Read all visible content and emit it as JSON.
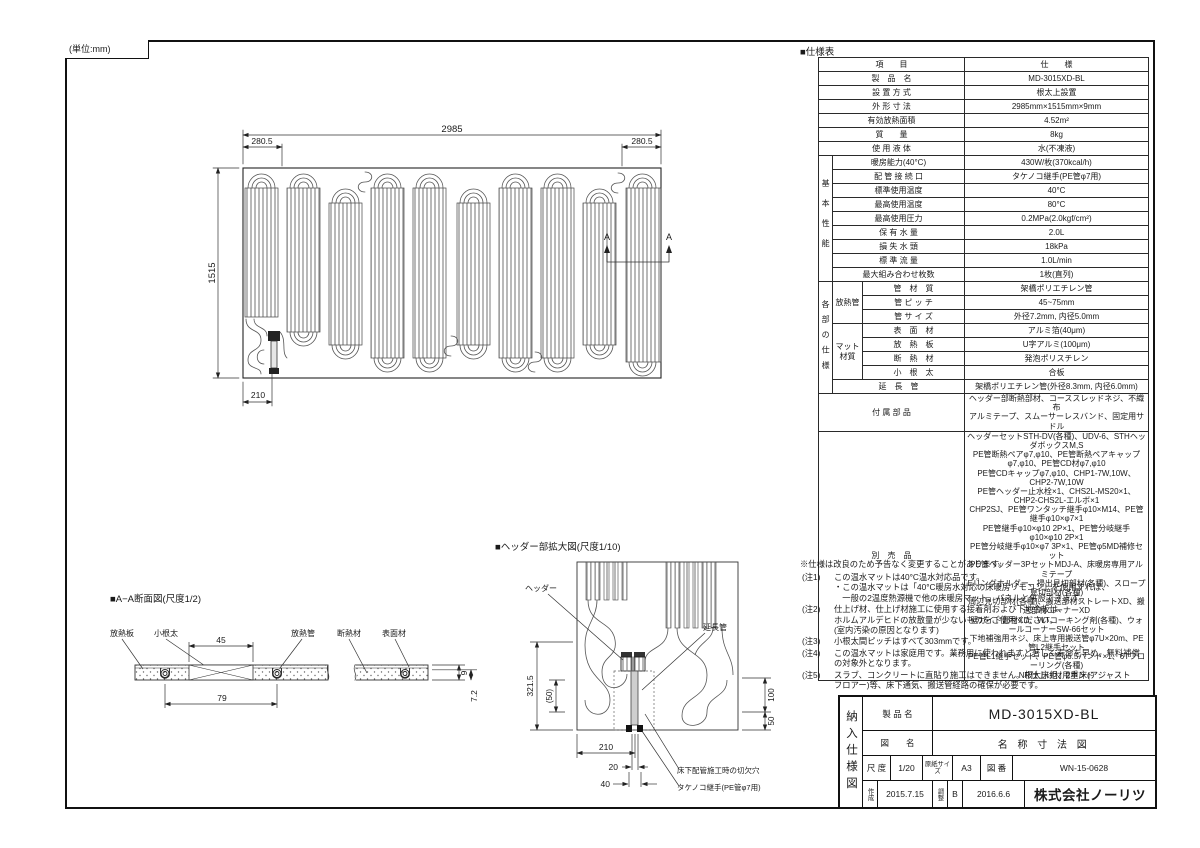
{
  "meta": {
    "unit": "(単位:mm)"
  },
  "plan": {
    "dim_overall_w": "2985",
    "dim_end_left": "280.5",
    "dim_end_right": "280.5",
    "dim_overall_h": "1515",
    "dim_header_x": "210",
    "marker": "A"
  },
  "section": {
    "title": "■A−A断面図(尺度1/2)",
    "label_plate": "放熱板",
    "label_joist": "小根太",
    "label_pipe": "放熱管",
    "label_insulation": "断熱材",
    "label_surface": "表面材",
    "dim_45": "45",
    "dim_79": "79",
    "dim_9": "9",
    "dim_72": "7.2"
  },
  "detail": {
    "title": "■ヘッダー部拡大図(尺度1/10)",
    "label_header": "ヘッダー",
    "label_extension": "延長管",
    "label_notch": "床下配管施工時の切欠穴",
    "label_fitting": "タケノコ継手(PE管φ7用)",
    "dim_3215": "321.5",
    "dim_50p": "(50)",
    "dim_100": "100",
    "dim_50": "50",
    "dim_210": "210",
    "dim_20": "20",
    "dim_40": "40"
  },
  "spec": {
    "title": "■仕様表",
    "col_item": "項　　目",
    "col_spec": "仕　　様",
    "simple": [
      {
        "label": "製　品　名",
        "value": "MD-3015XD-BL"
      },
      {
        "label": "設 置 方 式",
        "value": "根太上設置"
      },
      {
        "label": "外 形 寸 法",
        "value": "2985mm×1515mm×9mm"
      },
      {
        "label": "有効放熱面積",
        "value": "4.52m²"
      },
      {
        "label": "質　　量",
        "value": "8kg"
      },
      {
        "label": "使 用 液 体",
        "value": "水(不凍液)"
      }
    ],
    "basic_group": "基本性能",
    "basic": [
      {
        "label": "暖房能力(40°C)",
        "value": "430W/枚(370kcal/h)"
      },
      {
        "label": "配 管 接 続 口",
        "value": "タケノコ継手(PE管φ7用)"
      },
      {
        "label": "標準使用温度",
        "value": "40°C"
      },
      {
        "label": "最高使用温度",
        "value": "80°C"
      },
      {
        "label": "最高使用圧力",
        "value": "0.2MPa(2.0kgf/cm²)"
      },
      {
        "label": "保 有 水 量",
        "value": "2.0L"
      },
      {
        "label": "損 失 水 頭",
        "value": "18kPa"
      },
      {
        "label": "標 準 流 量",
        "value": "1.0L/min"
      },
      {
        "label": "最大組み合わせ枚数",
        "value": "1枚(直列)"
      }
    ],
    "parts_group": "各部の仕様",
    "pipe_group": "放熱管",
    "pipe": [
      {
        "label": "管　材　質",
        "value": "架橋ポリエチレン管"
      },
      {
        "label": "管 ピ ッ チ",
        "value": "45~75mm"
      },
      {
        "label": "管 サ イ ズ",
        "value": "外径7.2mm, 内径5.0mm"
      }
    ],
    "mat_group": "マット材質",
    "mat": [
      {
        "label": "表　面　材",
        "value": "アルミ箔(40μm)"
      },
      {
        "label": "放　熱　板",
        "value": "U字アルミ(100μm)"
      },
      {
        "label": "断　熱　材",
        "value": "発泡ポリスチレン"
      },
      {
        "label": "小　根　太",
        "value": "合板"
      }
    ],
    "extension_row": {
      "label": "延　長　管",
      "value": "架橋ポリエチレン管(外径8.3mm, 内径6.0mm)"
    },
    "accessories": {
      "label": "付 属 部 品",
      "value": "ヘッダー部断熱部材、コーススレッドネジ、不織布\nアルミテープ、スムーサーレスバンド、固定用サドル"
    },
    "optional": {
      "label": "別　売　品",
      "value": "ヘッダーセットSTH-DV(各種)、UDV-6、STHヘッダボックスM,S\nPE管断熱ペアφ7,φ10、PE管断熱ペアキャップφ7,φ10、PE管CD材φ7,φ10\nPE管CDキャップφ7,φ10、CHP1-7W,10W、CHP2-7W,10W\nPE管ヘッダー止水栓×1、CHS2L-MS20×1、CHP2-CHS2L-エルボ×1\nCHP2SJ、PE管ワンタッチ継手φ10×M14、PE管継手φ10×φ7×1\nPE管継手φ10×φ10 2P×1、PE管分岐継手φ10×φ10 2P×1\nPE管分岐継手φ10×φ7 3P×1、PE管φ5MD補修セット\nPE管ヘッダー3PセットMDJ-A、床暖房専用アルミテープ\nEリングホルダー、掃出見切部材(各種)、スロープ見切部材(各種)\n周辺見切部材(各種)、搬送部材ストレートXD、搬送部材コーナーXD\n壁ガイド部材XD、WTコーキング剤(各種)、ウォールコーナーSW-66セット\n下地補強用ネジ、床上専用搬送管φ7U×20m、PE管L2継手セット\nPE管L1継手セット、PE管φ6.5バンド×1、6Tフローリング(各種)\nNR仕上げ材用ボンド"
    },
    "disclaimer": "※仕様は改良のため予告なく変更することがあります。"
  },
  "notes": [
    {
      "no": "(注1)",
      "text": "この温水マットは40°C温水対応品です。\n・この温水マットは「40°C暖房水対応の床暖房リモコン」を使用すれば、\n　一般の2温度熱源機で他の床暖房マット、パネルと併設できます。"
    },
    {
      "no": "(注2)",
      "text": "仕上げ材、仕上げ材施工に使用する接着剤および下地合板は、\nホルムアルデヒドの放散量が少ないものをご使用ください。\n(室内汚染の原因となります)"
    },
    {
      "no": "(注3)",
      "text": "小根太間ピッチはすべて303mmです。"
    },
    {
      "no": "(注4)",
      "text": "この温水マットは家庭用です。業務用に使われますと著しく寿命を早め、無料補償\nの対象外となります。"
    },
    {
      "no": "(注5)",
      "text": "スラブ、コンクリートに直貼り施工はできません。根太床組、2重床(アジャスト\nフロアー)等、床下通気、搬送管経路の確保が必要です。"
    }
  ],
  "titleblock": {
    "side": "納入仕様図",
    "product_label": "製 品 名",
    "product": "MD-3015XD-BL",
    "drawing_label": "図　　名",
    "drawing": "名 称 寸 法 図",
    "scale_label": "尺 度",
    "scale": "1/20",
    "paper_label": "原紙サイズ",
    "paper": "A3",
    "no_label": "図 番",
    "no": "WN-15-0628",
    "created_label": "作成",
    "created": "2015.7.15",
    "adjusted_label": "調整",
    "rev": "B",
    "adjusted": "2016.6.6",
    "company": "株式会社ノーリツ"
  }
}
